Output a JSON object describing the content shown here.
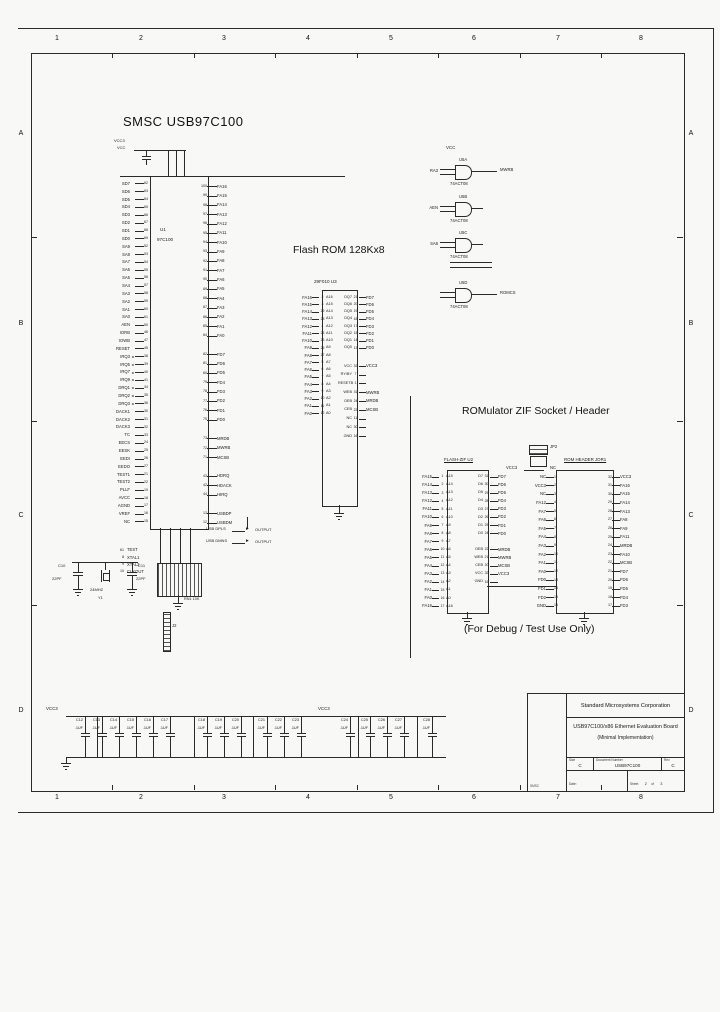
{
  "frame": {
    "cols": [
      "1",
      "2",
      "3",
      "4",
      "5",
      "6",
      "7",
      "8"
    ],
    "rows": [
      "A",
      "B",
      "C",
      "D"
    ]
  },
  "titles": {
    "main": "SMSC  USB97C100",
    "flash": "Flash ROM  128Kx8",
    "rom": "ROMulator ZIF Socket / Header",
    "debug": "(For Debug / Test Use Only)"
  },
  "u1": {
    "ref": "U1",
    "part": "97C100",
    "top1": "VCC3",
    "top2": "VCC",
    "left": [
      "SD7|62",
      "SD6|63",
      "SD5|64",
      "SD4|65",
      "SD3|66",
      "SD2|67",
      "SD1|68",
      "SD0|69",
      "SA9|52",
      "SA8|53",
      "SA7|54",
      "SA6|55",
      "SA5|56",
      "SA4|57",
      "SA3|58",
      "SA2|59",
      "SA1|60",
      "SA0|61",
      "AEN|50",
      "IORB|46",
      "IOWB|47",
      "RESET|45",
      "IRQ3|38|a",
      "IRQ5|39|a",
      "IRQ7|40|a",
      "IRQ9|41|a",
      "DRQ1|34|a",
      "DRQ2|35|a",
      "DRQ3|36|a",
      "DACK1|30",
      "DACK2|31",
      "DACK3|32",
      "TC|33",
      "EECS|24",
      "EESK|25",
      "EEDI|26",
      "EEDO|27",
      "TEST1|21",
      "TEST2|22",
      "PLLF|19",
      "AVCC|18",
      "AGND|17",
      "VREF|16",
      "NC|15"
    ],
    "right": [
      "100|FA16",
      "99|FA15",
      "98|FA14",
      "97|FA13",
      "96|FA12",
      "95|FA11",
      "94|FA10",
      "93|FA9",
      "92|FA8",
      "91|FA7",
      "90|FA6",
      "89|FA5",
      "88|FA4",
      "87|FA3",
      "86|FA2",
      "85|FA1",
      "84|FA0",
      "|",
      "82|FD7",
      "81|FD6",
      "80|FD5",
      "79|FD4",
      "78|FD3",
      "77|FD2",
      "76|FD1",
      "75|FD0",
      "|",
      "73|MRDB",
      "72|MWRB",
      "71|MCSB",
      "|",
      "43|HDRQ",
      "42|HDACK",
      "44|HIRQ",
      "|",
      "13|USBDP",
      "12|USBDM"
    ],
    "bottom": [
      "61|TEST",
      "8|XTAL1",
      "9|XTAL2",
      "10|CLKOUT"
    ]
  },
  "u3": {
    "header": "29F010    U3",
    "left": [
      "FA16|A16|2",
      "FA15|A15|3",
      "FA14|A14|29",
      "FA13|A13|28",
      "FA12|A12|4",
      "FA11|A11|25",
      "FA10|A10|23",
      "FA9|A9|26",
      "FA8|A8|27",
      "FA7|A7|5",
      "FA6|A6|6",
      "FA5|A5|7",
      "FA4|A4|8",
      "FA3|A3|9",
      "FA2|A2|10",
      "FA1|A1|11",
      "FA0|A0|12"
    ],
    "data": [
      "DQ7|21|FD7",
      "DQ6|20|FD6",
      "DQ5|19|FD5",
      "DQ4|18|FD4",
      "DQ3|17|FD3",
      "DQ2|15|FD2",
      "DQ1|14|FD1",
      "DQ0|13|FD0"
    ],
    "ctrl": [
      "VCC|32|VCC3",
      "RY/BY|7|",
      "RESETB|1|",
      "WEB|31|MWRB",
      "OEB|24|MRDB",
      "CEB|22|MCSB",
      "NC|11|",
      "NC|30|",
      "GND|16|"
    ]
  },
  "gates": {
    "vcc": "VCC",
    "type": "74ACT08",
    "items": [
      {
        "ref": "U5A",
        "in": "RA3",
        "out": "MWRB"
      },
      {
        "ref": "U5B",
        "in": "AEN",
        "out": ""
      },
      {
        "ref": "U5C",
        "in": "SA8",
        "out": ""
      },
      {
        "ref": "U5D",
        "in": "",
        "out": "ROMCS"
      }
    ]
  },
  "jp2": {
    "ref": "JP2",
    "left": "VCC3",
    "right": "NC"
  },
  "u2": {
    "header": "FLASH-ZIF  U2",
    "left": [
      "FA15|A15|1",
      "FA14|A14|2",
      "FA13|A13|3",
      "FA12|A12|4",
      "FA11|A11|5",
      "FA10|A10|6",
      "FA9|A9|7",
      "FA8|A8|8",
      "FA7|A7|9",
      "FA6|A6|10",
      "FA5|A5|11",
      "FA4|A4|12",
      "FA3|A3|13",
      "FA2|A2|14",
      "FA1|A1|15",
      "FA0|A0|16",
      "FA16|A16|17"
    ],
    "right": [
      "D7|31|FD7",
      "D6|30|FD6",
      "D5|29|FD5",
      "D4|28|FD4",
      "D3|27|FD3",
      "D2|26|FD2",
      "D1|25|FD1",
      "D0|24|FD0",
      "||",
      "OEB|22|MRDB",
      "WEB|21|MWRB",
      "CEB|20|MCSB",
      "VCC|32|VCC3",
      "GND|16|"
    ]
  },
  "j1": {
    "header": "ROM HEADER  JOR1",
    "left": [
      "NC|1",
      "VCC3|2",
      "NC|3",
      "FA12|4",
      "FA7|5",
      "FA6|6",
      "FA5|7",
      "FA4|8",
      "FA3|9",
      "FA2|10",
      "FA1|11",
      "FA0|12",
      "FD0|13",
      "FD1|14",
      "FD2|15",
      "GND|16"
    ],
    "right": [
      "32|VCC3",
      "31|FA16",
      "30|FA15",
      "29|FA14",
      "28|FA13",
      "27|FA8",
      "26|FA9",
      "25|FA11",
      "24|MRDB",
      "23|FA10",
      "22|MCSB",
      "21|FD7",
      "20|FD6",
      "19|FD5",
      "18|FD4",
      "17|FD3"
    ]
  },
  "xtal": {
    "c1": "C10",
    "c1v": "22PF",
    "c2": "C11",
    "c2v": "22PF",
    "y": "Y1",
    "yv": "24MHZ",
    "rn": "RN1  10K",
    "j": "J2"
  },
  "usb": {
    "rows": [
      {
        "sig": "USB DPLS",
        "out": "OUTPUT"
      },
      {
        "sig": "USB DMNS",
        "out": "OUTPUT"
      }
    ]
  },
  "caps": {
    "rail": "VCC3",
    "value": ".1UF",
    "refs": [
      "C12",
      "C13",
      "C14",
      "C15",
      "C16",
      "C17",
      "C18",
      "C19",
      "C20",
      "C21",
      "C22",
      "C23",
      "C24",
      "C25",
      "C26",
      "C27",
      "C28"
    ]
  },
  "titleblock": {
    "strip_note": "SMSC",
    "company": "Standard Microsystems Corporation",
    "title1": "USB97C100/x86 Ethernet Evaluation Board",
    "title2": "(Minimal Implementation)",
    "size_label": "Size",
    "size": "C",
    "doc_label": "Document Number",
    "doc": "USB97C100",
    "rev_label": "Rev",
    "rev": "C",
    "date_label": "Date:",
    "date": "",
    "sheet_label": "Sheet",
    "sheet": "2",
    "of_label": "of",
    "of": "3"
  }
}
